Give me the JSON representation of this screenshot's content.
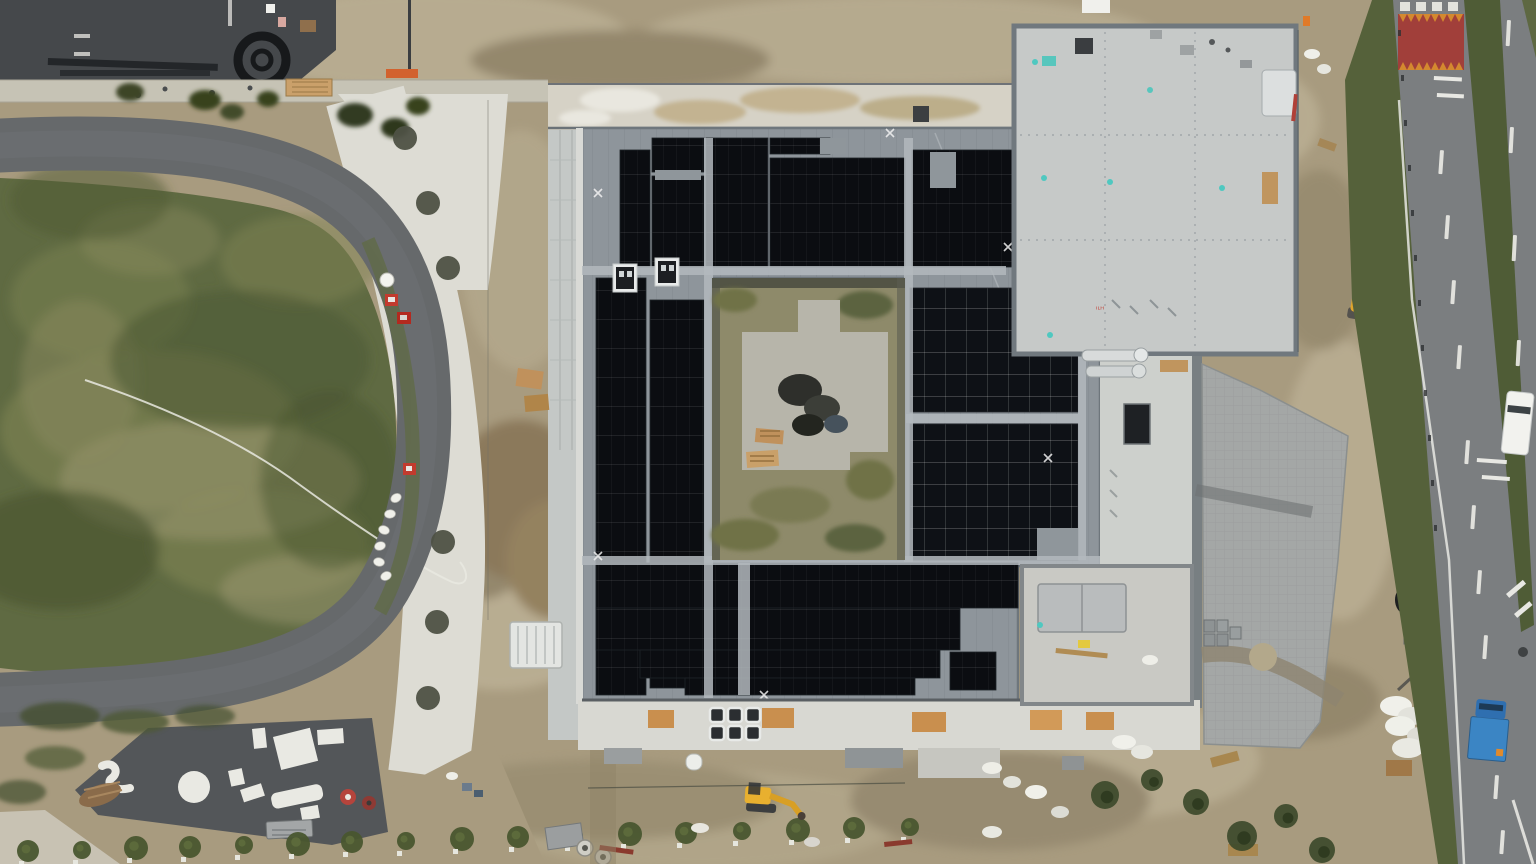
{
  "scene": {
    "description": "Aerial drone photo of a school construction site: square building with courtyard, roof covered in black solar panels, oval grass field with ring road on the left, public road on the right",
    "no_visible_text": true,
    "roof_marking": "small illegible red marking on flat roof"
  },
  "palette": {
    "dirt": "#a89b7f",
    "dirt_light": "#c0b59a",
    "dirt_dark": "#8a7e63",
    "grass_field": "#5f6a42",
    "grass_worn": "#9b9770",
    "ring_road": "#66696b",
    "playground_asphalt": "#535659",
    "concrete_path": "#dddcd4",
    "metal_roof": "#8e959b",
    "flat_roof": "#c6c9c8",
    "solar_panel": "#0b0d11",
    "paving": "#a4a7a6",
    "road": "#7b7e80",
    "red_zone": "#a13f3a",
    "zone_teeth": "#d4892f",
    "median_grass": "#4f5c36"
  },
  "building": {
    "solar": {
      "arrays_typeA": [
        [
          620,
          150,
          30,
          117
        ],
        [
          652,
          138,
          52,
          34
        ],
        [
          652,
          176,
          52,
          91
        ],
        [
          706,
          138,
          62,
          129
        ],
        [
          770,
          158,
          135,
          109
        ],
        [
          770,
          138,
          60,
          16
        ],
        [
          912,
          150,
          120,
          117
        ],
        [
          1034,
          138,
          100,
          129
        ],
        [
          1134,
          138,
          50,
          130
        ],
        [
          1184,
          138,
          46,
          102
        ],
        [
          596,
          278,
          50,
          417
        ],
        [
          650,
          300,
          54,
          388
        ],
        [
          596,
          563,
          422,
          45
        ],
        [
          596,
          608,
          364,
          42
        ],
        [
          640,
          650,
          300,
          28
        ],
        [
          685,
          678,
          230,
          17
        ],
        [
          950,
          652,
          46,
          38
        ]
      ],
      "arrays_typeB": [
        [
          910,
          288,
          168,
          124
        ],
        [
          910,
          424,
          168,
          136
        ]
      ],
      "gaps": [
        [
          930,
          152,
          26,
          36
        ],
        [
          655,
          170,
          46,
          10
        ],
        [
          820,
          138,
          26,
          16
        ],
        [
          1037,
          528,
          41,
          32
        ]
      ],
      "walkways": [
        [
          704,
          138,
          9,
          560
        ],
        [
          904,
          138,
          9,
          424
        ],
        [
          582,
          266,
          424,
          9
        ],
        [
          582,
          556,
          520,
          9
        ],
        [
          906,
          414,
          172,
          9
        ],
        [
          1078,
          288,
          8,
          272
        ],
        [
          738,
          563,
          12,
          132
        ]
      ],
      "anchor_marks": [
        [
          598,
          193
        ],
        [
          890,
          133
        ],
        [
          1008,
          247
        ],
        [
          598,
          556
        ],
        [
          1048,
          458
        ],
        [
          764,
          695
        ]
      ]
    },
    "vents": {
      "xs": [
        710,
        728,
        746
      ],
      "ys": [
        708,
        726
      ],
      "size": 14
    }
  },
  "landscape": {
    "tree_pits": [
      [
        405,
        138
      ],
      [
        428,
        203
      ],
      [
        448,
        268
      ],
      [
        443,
        542
      ],
      [
        437,
        622
      ],
      [
        428,
        698
      ]
    ],
    "street_trees_x": [
      28,
      82,
      136,
      190,
      244,
      298,
      352,
      406,
      462,
      518,
      574,
      630,
      686,
      742,
      798,
      854,
      910
    ],
    "white_bundles": [
      [
        396,
        498
      ],
      [
        390,
        514
      ],
      [
        384,
        530
      ],
      [
        380,
        546
      ],
      [
        379,
        562
      ],
      [
        386,
        576
      ]
    ],
    "bottom_right_trees": [
      [
        1105,
        795,
        14
      ],
      [
        1152,
        780,
        11
      ],
      [
        1196,
        802,
        13
      ],
      [
        1242,
        836,
        15
      ],
      [
        1286,
        816,
        12
      ],
      [
        1322,
        850,
        13
      ],
      [
        1440,
        778,
        12
      ],
      [
        1468,
        806,
        10
      ]
    ]
  },
  "roads": {
    "dashes_a": [
      [
        1440,
        150
      ],
      [
        1446,
        215
      ],
      [
        1452,
        280
      ],
      [
        1458,
        345
      ],
      [
        1466,
        440
      ],
      [
        1472,
        505
      ],
      [
        1478,
        570
      ],
      [
        1484,
        635
      ],
      [
        1495,
        775
      ],
      [
        1501,
        830
      ]
    ],
    "dashes_b": [
      [
        1507,
        20
      ],
      [
        1510,
        127
      ],
      [
        1513,
        235
      ],
      [
        1517,
        340
      ]
    ],
    "fence_posts": [
      [
        1398,
        30
      ],
      [
        1401,
        75
      ],
      [
        1404,
        120
      ],
      [
        1408,
        165
      ],
      [
        1411,
        210
      ],
      [
        1414,
        255
      ],
      [
        1418,
        300
      ],
      [
        1421,
        345
      ],
      [
        1424,
        390
      ],
      [
        1428,
        435
      ],
      [
        1431,
        480
      ],
      [
        1434,
        525
      ]
    ],
    "red_zone": {
      "x": 1398,
      "y": 14,
      "w": 66,
      "h": 56,
      "teeth": 8
    }
  },
  "vehicles": {
    "red_cars_on_ring_road": 2,
    "red_container_near_field": 1,
    "blue_truck_on_road": 1,
    "white_van_on_far_road": 1,
    "yellow_excavator_east": 1,
    "yellow_mini_excavator_south": 1,
    "colors": {
      "red": "#c23b2e",
      "blue": "#3b85c4",
      "white": "#f2f2ee",
      "yellow": "#e0a52c"
    }
  }
}
